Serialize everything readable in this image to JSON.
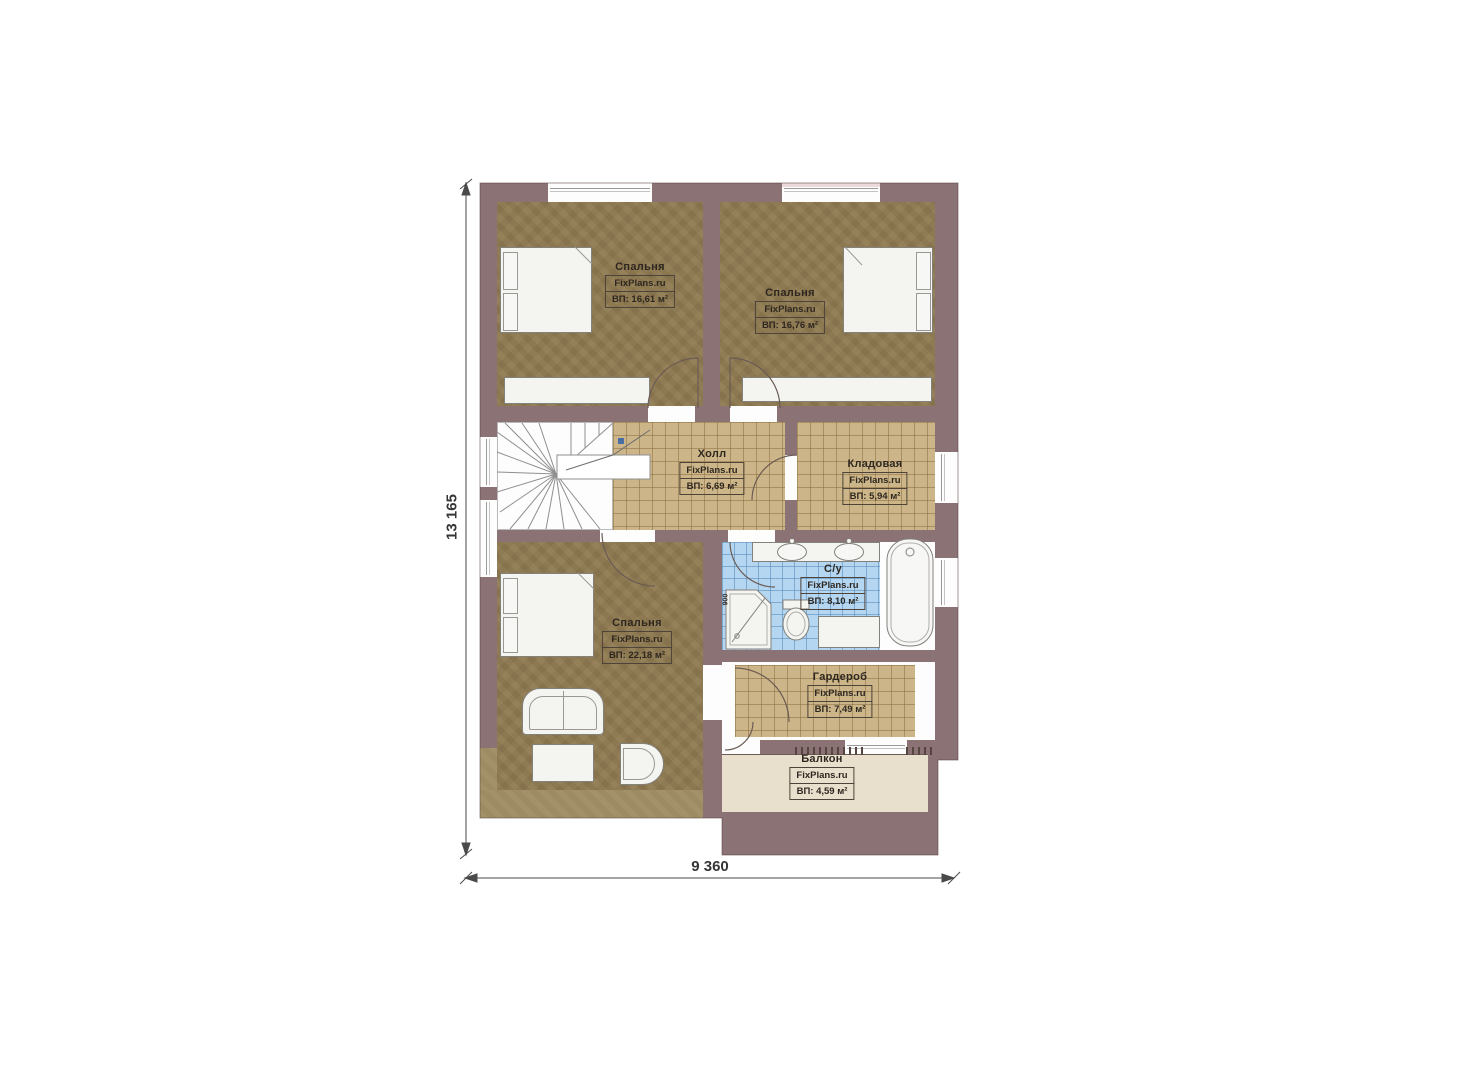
{
  "plan": {
    "rooms": [
      {
        "key": "bedroom-top-left",
        "name": "Спальня",
        "site": "FixPlans.ru",
        "area": "ВП: 16,61 м²"
      },
      {
        "key": "bedroom-top-right",
        "name": "Спальня",
        "site": "FixPlans.ru",
        "area": "ВП: 16,76 м²"
      },
      {
        "key": "hall",
        "name": "Холл",
        "site": "FixPlans.ru",
        "area": "ВП: 6,69 м²"
      },
      {
        "key": "storage",
        "name": "Кладовая",
        "site": "FixPlans.ru",
        "area": "ВП: 5,94 м²"
      },
      {
        "key": "bathroom",
        "name": "С/у",
        "site": "FixPlans.ru",
        "area": "ВП: 8,10 м²"
      },
      {
        "key": "bedroom-bottom",
        "name": "Спальня",
        "site": "FixPlans.ru",
        "area": "ВП: 22,18 м²"
      },
      {
        "key": "wardrobe",
        "name": "Гардероб",
        "site": "FixPlans.ru",
        "area": "ВП: 7,49 м²"
      },
      {
        "key": "balcony",
        "name": "Балкон",
        "site": "FixPlans.ru",
        "area": "ВП: 4,59 м²"
      }
    ],
    "dimensions": {
      "height_label": "13 165",
      "width_label": "9 360",
      "shower_label": "900"
    },
    "colors": {
      "wall": "#8b7275",
      "bedroom_floor": "#8d7951",
      "eaves": "#9d8c63",
      "tile_floor": "#ccb689",
      "bath_floor": "#b4d6f1",
      "balcony_floor": "#e9dfcd",
      "stairs": "#ffffff",
      "marker_blue": "#4a6fa5"
    }
  }
}
